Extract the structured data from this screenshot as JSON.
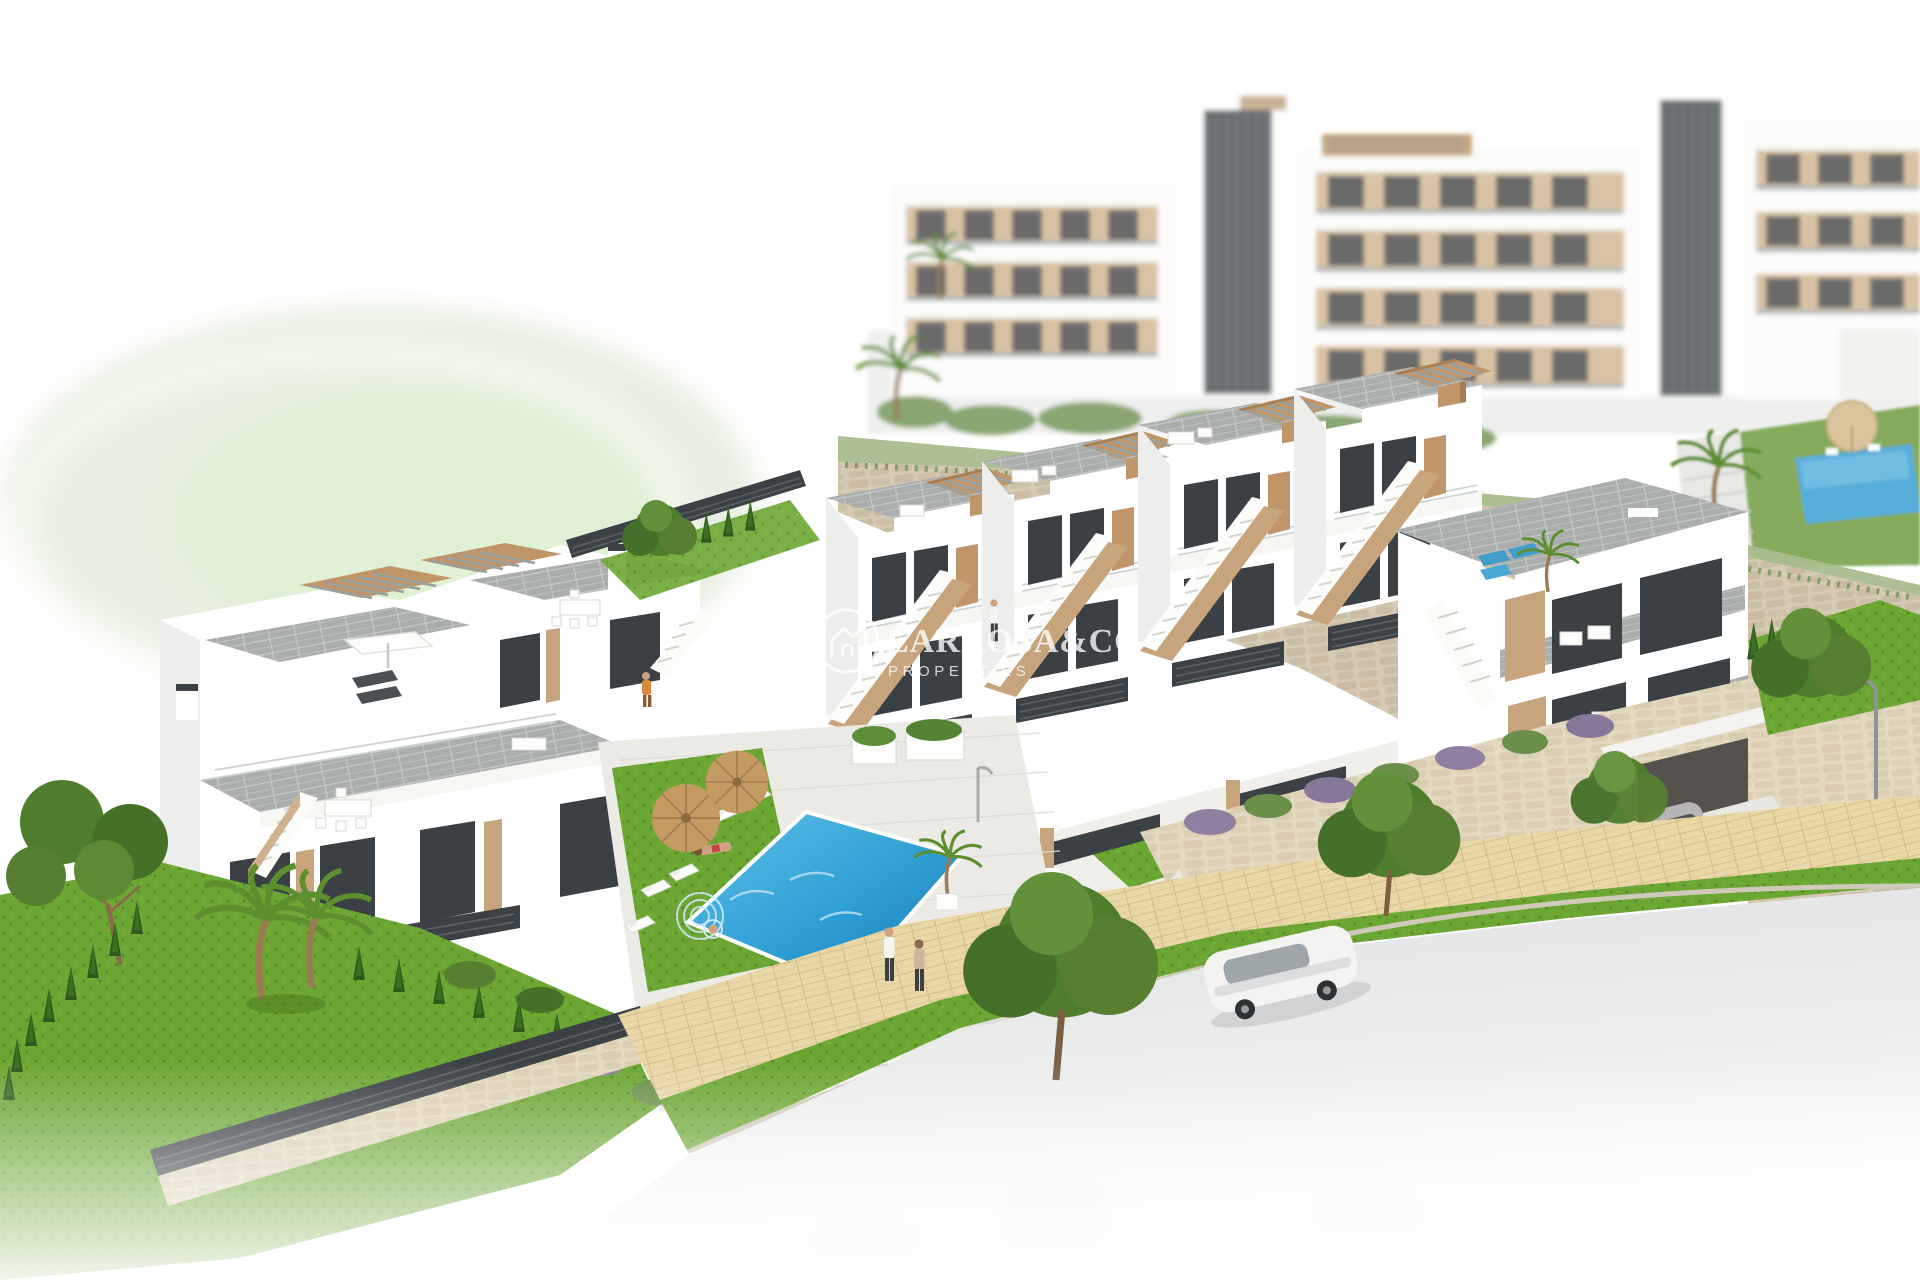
{
  "watermark": {
    "brand": "LARROSA&CO",
    "tagline": "PROPERTIES",
    "logo_icon": "house-roofline-in-circle",
    "color": "#ffffff",
    "opacity": 0.78
  },
  "scene": {
    "type": "3d-architectural-render",
    "view": "aerial",
    "description": "Aerial render of a modern white hillside residential development: terraced townhouses with wood pergolas and roof terraces, a communal pool with sun loungers and straw umbrellas, gardens with pines, palms and cypresses, stone retaining walls, a street with cars and pedestrians, and blurred apartment blocks behind.",
    "areas": {
      "background_apartments": "blurred white multi-storey apartment blocks with tan balconies and dark stair cores",
      "upper_terrace": "small blue pool with beige parasol on the upper level behind the stone wall",
      "middle_row": {
        "label": "terraced townhouses",
        "units": 4,
        "features": [
          "external stairs",
          "roof pergolas",
          "tan accent towers",
          "dark slat fences"
        ]
      },
      "corner_unit": {
        "label": "corner townhouse",
        "features": [
          "large roof terrace",
          "blue sun loungers",
          "palm",
          "garage with driveway"
        ]
      },
      "left_block": {
        "label": "left townhouse block",
        "units": 2,
        "features": [
          "roof pergolas",
          "white parasol",
          "dining sets",
          "chimneys",
          "zigzag stair"
        ]
      },
      "pool_area": {
        "label": "communal pool",
        "sun_loungers": 6,
        "straw_umbrellas": 2,
        "swimmer": 1,
        "sunbather": 1
      },
      "garden": "lawn with pine tree, palm cluster, cypress hedge and dark slat fence on a stone base",
      "street": {
        "sidewalk": "sand-coloured pavers",
        "pedestrians": 2,
        "cars": [
          "white sedan",
          "grey coupe on driveway"
        ],
        "lamppost": 1
      }
    }
  },
  "palette": {
    "blob": "#e7efe0",
    "pool": "#2f9fd4",
    "pool_deep": "#1777b5",
    "pool_small": "#57aeda",
    "grass": "#6ca733",
    "grass_dark": "#49791f",
    "foliage": "#4e7d2c",
    "foliage_dark": "#2e5a1d",
    "stone": "#d6cab4",
    "stone_dark": "#bfb097",
    "stone_light": "#e3d8c0",
    "tile": "#a9adac",
    "wood": "#c0956a",
    "tan": "#c8a47c",
    "fence": "#3b4145",
    "glass": "#3a4044",
    "road": "#dfe1e2",
    "paving": "#e9d7a8",
    "paving_line": "#d3bc8a",
    "car_gray": "#b7b4b6",
    "skin": "#cfa183",
    "watermark": "#ffffff"
  }
}
